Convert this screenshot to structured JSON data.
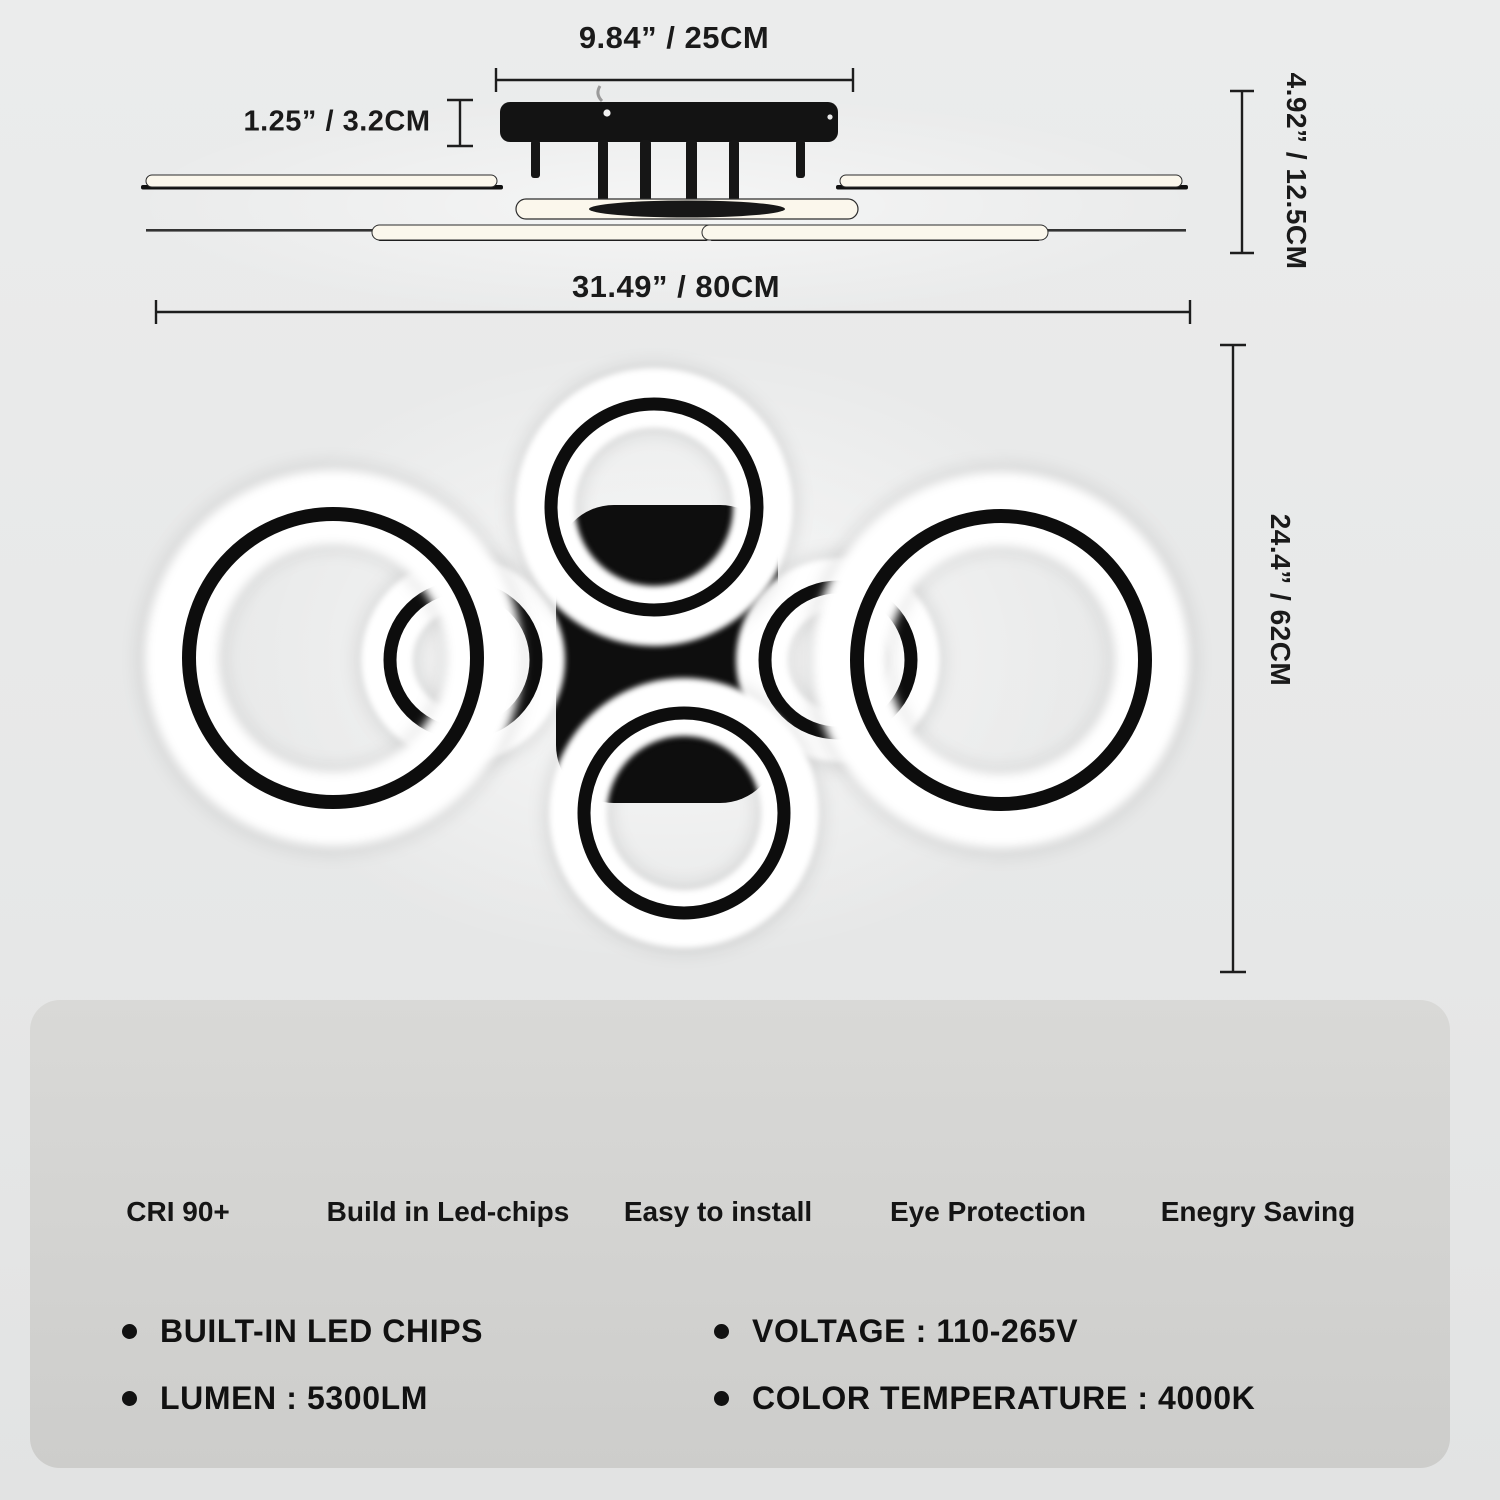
{
  "product": "LED ring ceiling lamp dimension diagram",
  "dimensions": {
    "canopy_width": "9.84” / 25CM",
    "canopy_height": "1.25” / 3.2CM",
    "fixture_height": "4.92” / 12.5CM",
    "fixture_width": "31.49” / 80CM",
    "fixture_depth": "24.4” / 62CM"
  },
  "features": [
    {
      "icon": "cri-icon",
      "label": "CRI 90+"
    },
    {
      "icon": "chip-icon",
      "label": "Build in Led-chips"
    },
    {
      "icon": "tools-icon",
      "label": "Easy to install"
    },
    {
      "icon": "eye-icon",
      "label": "Eye Protection"
    },
    {
      "icon": "leaf-icon",
      "label": "Enegry Saving"
    }
  ],
  "specs": [
    "BUILT-IN LED CHIPS",
    "LUMEN : 5300LM",
    "VOLTAGE : 110-265V",
    "COLOR TEMPERATURE : 4000K"
  ],
  "colors": {
    "background": "#e8e9e9",
    "panel": "#d4d4d2",
    "ink": "#1a1a1a",
    "lamp_black": "#111111",
    "glow_white": "#ffffff",
    "warm_white": "#fbf7ec"
  }
}
